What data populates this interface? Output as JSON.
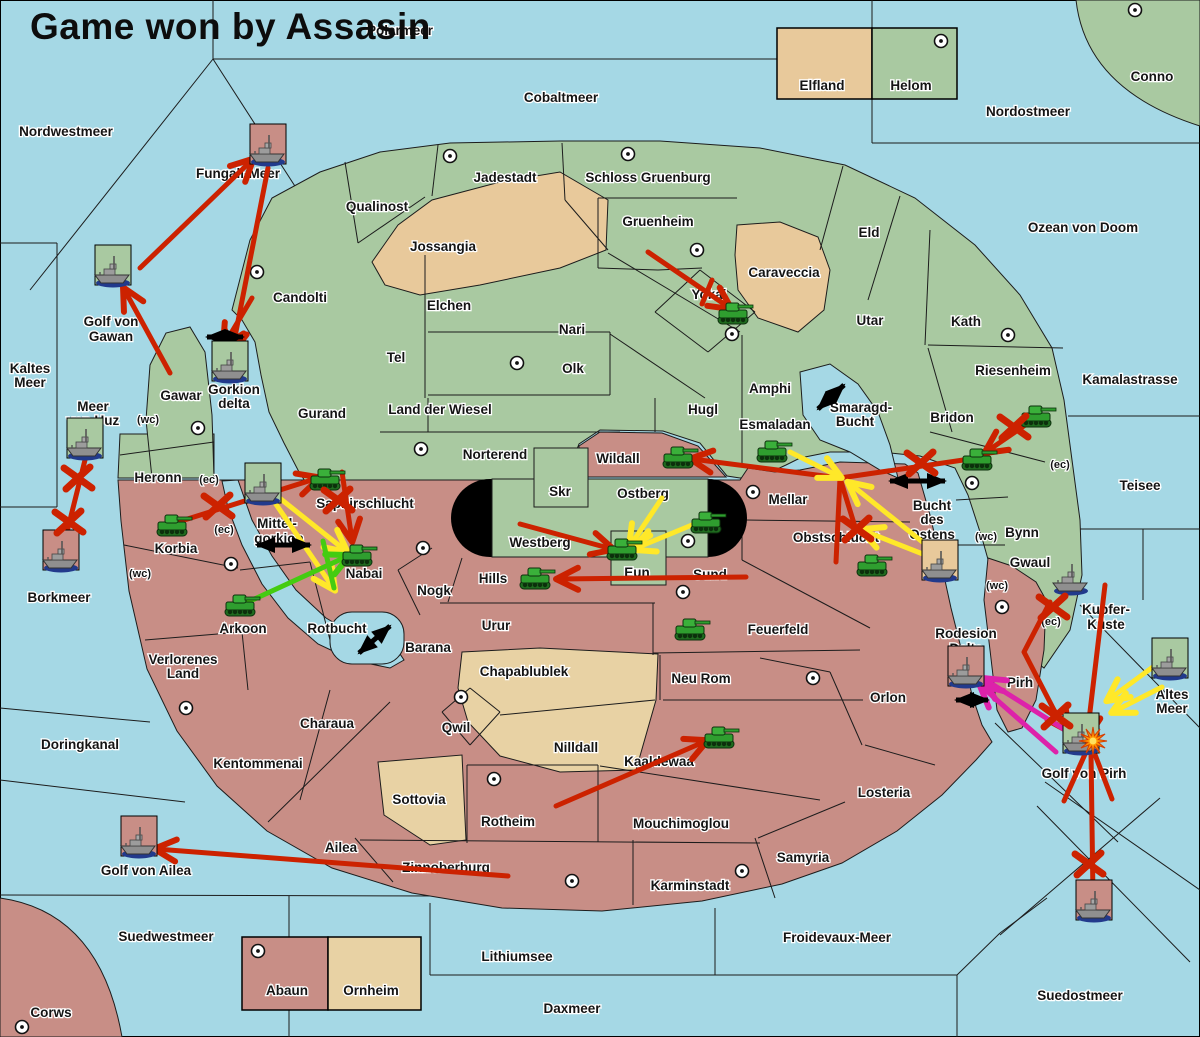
{
  "title": "Game won by Assasin",
  "colors": {
    "sea": "#a5d8e5",
    "land_green": "#a9c9a1",
    "land_tan": "#e8c99b",
    "land_pale": "#e8d2a4",
    "land_red": "#c88e86",
    "border": "#1c1c1c",
    "arrow_red": "#cc2200",
    "arrow_yellow": "#ffe829",
    "arrow_green": "#44cc11",
    "arrow_magenta": "#dd22aa",
    "arrow_black": "#000000",
    "tank": "#2f9e2f",
    "ship": "#8f8f8f",
    "ship_shadow": "#223a8c",
    "capsule": "#000000"
  },
  "legend_top": {
    "x": 777,
    "y": 28,
    "w": 180,
    "h": 71,
    "divider": 872,
    "items": [
      {
        "label": "Elfland",
        "color_key": "land_tan",
        "lx": 822,
        "ly": 90
      },
      {
        "label": "Helom",
        "color_key": "land_green",
        "lx": 911,
        "ly": 90
      }
    ]
  },
  "legend_bottom": {
    "x": 242,
    "y": 937,
    "w": 179,
    "h": 73,
    "divider": 328,
    "items": [
      {
        "label": "Abaun",
        "color_key": "land_red",
        "lx": 287,
        "ly": 995
      },
      {
        "label": "Ornheim",
        "color_key": "land_pale",
        "lx": 371,
        "ly": 995
      }
    ]
  },
  "labels": [
    {
      "t": "Polarmeer",
      "x": 400,
      "y": 35
    },
    {
      "t": "Nordwestmeer",
      "x": 66,
      "y": 136
    },
    {
      "t": "Cobaltmeer",
      "x": 561,
      "y": 102
    },
    {
      "t": "Nordostmeer",
      "x": 1028,
      "y": 116
    },
    {
      "t": "Conno",
      "x": 1152,
      "y": 81
    },
    {
      "t": "Ozean von Doom",
      "x": 1083,
      "y": 232
    },
    {
      "t": "Fungali-Meer",
      "x": 238,
      "y": 178
    },
    {
      "t": "Jadestadt",
      "x": 505,
      "y": 182
    },
    {
      "t": "Schloss Gruenburg",
      "x": 648,
      "y": 182
    },
    {
      "t": "Qualinost",
      "x": 377,
      "y": 211
    },
    {
      "t": "Jossangia",
      "x": 443,
      "y": 251
    },
    {
      "t": "Gruenheim",
      "x": 658,
      "y": 226
    },
    {
      "t": "Caraveccia",
      "x": 784,
      "y": 277
    },
    {
      "t": "Eld",
      "x": 869,
      "y": 237
    },
    {
      "t": "Yokai",
      "x": 709,
      "y": 299
    },
    {
      "t": "Utar",
      "x": 870,
      "y": 325
    },
    {
      "t": "Kath",
      "x": 966,
      "y": 326
    },
    {
      "t": "Riesenheim",
      "x": 1013,
      "y": 375
    },
    {
      "t": "Kamalastrasse",
      "x": 1130,
      "y": 384
    },
    {
      "t": "Candolti",
      "x": 300,
      "y": 302
    },
    {
      "t": "Elchen",
      "x": 449,
      "y": 310
    },
    {
      "t": "Nari",
      "x": 572,
      "y": 334
    },
    {
      "t": "Tel",
      "x": 396,
      "y": 362
    },
    {
      "t": "Olk",
      "x": 573,
      "y": 373
    },
    {
      "t": "Golf von",
      "x": 111,
      "y": 326
    },
    {
      "t": "Gawan",
      "x": 111,
      "y": 341
    },
    {
      "t": "Kaltes",
      "x": 30,
      "y": 373
    },
    {
      "t": "Meer",
      "x": 30,
      "y": 387
    },
    {
      "t": "Meer",
      "x": 93,
      "y": 411
    },
    {
      "t": "von Uuz",
      "x": 93,
      "y": 425
    },
    {
      "t": "Gawar",
      "x": 181,
      "y": 400
    },
    {
      "t": "Gorkion",
      "x": 234,
      "y": 394
    },
    {
      "t": "delta",
      "x": 234,
      "y": 408
    },
    {
      "t": "Gurand",
      "x": 322,
      "y": 418
    },
    {
      "t": "Land der Wiesel",
      "x": 440,
      "y": 414
    },
    {
      "t": "Hugl",
      "x": 703,
      "y": 414
    },
    {
      "t": "Amphi",
      "x": 770,
      "y": 393
    },
    {
      "t": "Esmaladan",
      "x": 775,
      "y": 429
    },
    {
      "t": "Smaragd-",
      "x": 861,
      "y": 412
    },
    {
      "t": "Bucht",
      "x": 855,
      "y": 426
    },
    {
      "t": "Bridon",
      "x": 952,
      "y": 422
    },
    {
      "t": "Teisee",
      "x": 1140,
      "y": 490
    },
    {
      "t": "Norterend",
      "x": 495,
      "y": 459
    },
    {
      "t": "Wildall",
      "x": 618,
      "y": 463
    },
    {
      "t": "Heronn",
      "x": 158,
      "y": 482
    },
    {
      "t": "Skr",
      "x": 560,
      "y": 496
    },
    {
      "t": "Ostberg",
      "x": 643,
      "y": 498
    },
    {
      "t": "Mellar",
      "x": 788,
      "y": 504
    },
    {
      "t": "Bucht",
      "x": 932,
      "y": 510
    },
    {
      "t": "des",
      "x": 932,
      "y": 524
    },
    {
      "t": "Ostens",
      "x": 932,
      "y": 539
    },
    {
      "t": "Bynn",
      "x": 1022,
      "y": 537
    },
    {
      "t": "Saphirschlucht",
      "x": 365,
      "y": 508
    },
    {
      "t": "Mittel-",
      "x": 277,
      "y": 528
    },
    {
      "t": "gorkion",
      "x": 279,
      "y": 543
    },
    {
      "t": "Korbia",
      "x": 176,
      "y": 553
    },
    {
      "t": "Westberg",
      "x": 540,
      "y": 547
    },
    {
      "t": "Gwaul",
      "x": 1030,
      "y": 567
    },
    {
      "t": "Hills",
      "x": 493,
      "y": 583
    },
    {
      "t": "Eun",
      "x": 637,
      "y": 577
    },
    {
      "t": "Sund",
      "x": 710,
      "y": 579
    },
    {
      "t": "Obstschlucht",
      "x": 836,
      "y": 542
    },
    {
      "t": "Nabai",
      "x": 364,
      "y": 578
    },
    {
      "t": "Borkmeer",
      "x": 59,
      "y": 602
    },
    {
      "t": "Kupfer-",
      "x": 1106,
      "y": 614
    },
    {
      "t": "Küste",
      "x": 1106,
      "y": 629
    },
    {
      "t": "Nogk",
      "x": 434,
      "y": 595
    },
    {
      "t": "Arkoon",
      "x": 243,
      "y": 633
    },
    {
      "t": "Rotbucht",
      "x": 337,
      "y": 633
    },
    {
      "t": "Barana",
      "x": 428,
      "y": 652
    },
    {
      "t": "Urur",
      "x": 496,
      "y": 630
    },
    {
      "t": "Rodesion",
      "x": 966,
      "y": 638
    },
    {
      "t": "Delta",
      "x": 966,
      "y": 653
    },
    {
      "t": "Verlorenes",
      "x": 183,
      "y": 664
    },
    {
      "t": "Land",
      "x": 183,
      "y": 678
    },
    {
      "t": "Chapablublek",
      "x": 524,
      "y": 676
    },
    {
      "t": "Neu Rom",
      "x": 701,
      "y": 683
    },
    {
      "t": "Feuerfeld",
      "x": 778,
      "y": 634
    },
    {
      "t": "Orlon",
      "x": 888,
      "y": 702
    },
    {
      "t": "Pirh",
      "x": 1020,
      "y": 687
    },
    {
      "t": "Altes",
      "x": 1172,
      "y": 699
    },
    {
      "t": "Meer",
      "x": 1172,
      "y": 713
    },
    {
      "t": "Golf von Pirh",
      "x": 1084,
      "y": 778
    },
    {
      "t": "Doringkanal",
      "x": 80,
      "y": 749
    },
    {
      "t": "Charaua",
      "x": 327,
      "y": 728
    },
    {
      "t": "Qwil",
      "x": 456,
      "y": 732
    },
    {
      "t": "Kentommenai",
      "x": 258,
      "y": 768
    },
    {
      "t": "Nilldall",
      "x": 576,
      "y": 752
    },
    {
      "t": "Kaaldewaa",
      "x": 659,
      "y": 766
    },
    {
      "t": "Sottovia",
      "x": 419,
      "y": 804
    },
    {
      "t": "Rotheim",
      "x": 508,
      "y": 826
    },
    {
      "t": "Mouchimoglou",
      "x": 681,
      "y": 828
    },
    {
      "t": "Losteria",
      "x": 884,
      "y": 797
    },
    {
      "t": "Ailea",
      "x": 341,
      "y": 852
    },
    {
      "t": "Zinnoberburg",
      "x": 446,
      "y": 872
    },
    {
      "t": "Samyria",
      "x": 803,
      "y": 862
    },
    {
      "t": "Karminstadt",
      "x": 690,
      "y": 890
    },
    {
      "t": "Golf von Ailea",
      "x": 146,
      "y": 875
    },
    {
      "t": "Froidevaux-Meer",
      "x": 837,
      "y": 942
    },
    {
      "t": "Suedwestmeer",
      "x": 166,
      "y": 941
    },
    {
      "t": "Lithiumsee",
      "x": 517,
      "y": 961
    },
    {
      "t": "Daxmeer",
      "x": 572,
      "y": 1013
    },
    {
      "t": "Suedostmeer",
      "x": 1080,
      "y": 1000
    },
    {
      "t": "Corws",
      "x": 51,
      "y": 1017
    }
  ],
  "coast_tags": [
    {
      "t": "(wc)",
      "x": 148,
      "y": 423
    },
    {
      "t": "(ec)",
      "x": 209,
      "y": 483
    },
    {
      "t": "(ec)",
      "x": 224,
      "y": 533
    },
    {
      "t": "(wc)",
      "x": 140,
      "y": 577
    },
    {
      "t": "(ec)",
      "x": 1060,
      "y": 468
    },
    {
      "t": "(wc)",
      "x": 986,
      "y": 540
    },
    {
      "t": "(wc)",
      "x": 997,
      "y": 589
    },
    {
      "t": "(ec)",
      "x": 1051,
      "y": 625
    }
  ],
  "supply_centers": [
    [
      450,
      156
    ],
    [
      628,
      154
    ],
    [
      941,
      41
    ],
    [
      1135,
      10
    ],
    [
      257,
      272
    ],
    [
      517,
      363
    ],
    [
      697,
      250
    ],
    [
      732,
      334
    ],
    [
      1008,
      335
    ],
    [
      198,
      428
    ],
    [
      421,
      449
    ],
    [
      688,
      541
    ],
    [
      683,
      592
    ],
    [
      753,
      492
    ],
    [
      972,
      483
    ],
    [
      231,
      564
    ],
    [
      423,
      548
    ],
    [
      186,
      708
    ],
    [
      461,
      697
    ],
    [
      494,
      779
    ],
    [
      572,
      881
    ],
    [
      742,
      871
    ],
    [
      813,
      678
    ],
    [
      1002,
      607
    ],
    [
      22,
      1027
    ],
    [
      258,
      951
    ]
  ],
  "tanks": [
    [
      733,
      313
    ],
    [
      678,
      457
    ],
    [
      706,
      522
    ],
    [
      622,
      549
    ],
    [
      535,
      578
    ],
    [
      172,
      525
    ],
    [
      325,
      479
    ],
    [
      357,
      555
    ],
    [
      240,
      605
    ],
    [
      772,
      451
    ],
    [
      872,
      565
    ],
    [
      690,
      629
    ],
    [
      719,
      737
    ],
    [
      977,
      459
    ],
    [
      1036,
      416
    ]
  ],
  "fleets": [
    {
      "x": 268,
      "y": 150,
      "sq": "land_red"
    },
    {
      "x": 113,
      "y": 271,
      "sq": "land_green"
    },
    {
      "x": 230,
      "y": 367,
      "sq": "land_green"
    },
    {
      "x": 85,
      "y": 444,
      "sq": "land_green"
    },
    {
      "x": 61,
      "y": 556,
      "sq": "land_red"
    },
    {
      "x": 263,
      "y": 489,
      "sq": "land_green"
    },
    {
      "x": 940,
      "y": 566,
      "sq": "land_tan"
    },
    {
      "x": 1071,
      "y": 579,
      "sq": null
    },
    {
      "x": 966,
      "y": 672,
      "sq": "land_red"
    },
    {
      "x": 1081,
      "y": 739,
      "sq": "land_green",
      "explode": true
    },
    {
      "x": 1170,
      "y": 664,
      "sq": "land_green"
    },
    {
      "x": 1094,
      "y": 906,
      "sq": "land_red"
    },
    {
      "x": 139,
      "y": 842,
      "sq": "land_red"
    }
  ],
  "arrows": [
    {
      "c": "red",
      "h": 1,
      "p": [
        [
          140,
          268
        ],
        [
          252,
          160
        ]
      ]
    },
    {
      "c": "red",
      "h": 1,
      "p": [
        [
          170,
          373
        ],
        [
          124,
          289
        ]
      ]
    },
    {
      "c": "red",
      "h": 1,
      "p": [
        [
          268,
          168
        ],
        [
          232,
          352
        ]
      ]
    },
    {
      "c": "red",
      "h": 1,
      "p": [
        [
          252,
          298
        ],
        [
          224,
          345
        ]
      ]
    },
    {
      "c": "red",
      "h": 0,
      "p": [
        [
          85,
          460
        ],
        [
          63,
          548
        ]
      ]
    },
    {
      "c": "red",
      "h": 1,
      "p": [
        [
          178,
          522
        ],
        [
          318,
          478
        ]
      ]
    },
    {
      "c": "red",
      "h": 1,
      "p": [
        [
          342,
          472
        ],
        [
          352,
          540
        ]
      ]
    },
    {
      "c": "red",
      "h": 1,
      "p": [
        [
          746,
          577
        ],
        [
          558,
          579
        ]
      ]
    },
    {
      "c": "red",
      "h": 1,
      "p": [
        [
          520,
          524
        ],
        [
          612,
          549
        ]
      ]
    },
    {
      "c": "red",
      "h": 1,
      "p": [
        [
          977,
          458
        ],
        [
          840,
          478
        ],
        [
          692,
          459
        ]
      ]
    },
    {
      "c": "red",
      "h": 0,
      "p": [
        [
          840,
          478
        ],
        [
          856,
          530
        ]
      ]
    },
    {
      "c": "red",
      "h": 0,
      "p": [
        [
          840,
          478
        ],
        [
          836,
          562
        ]
      ]
    },
    {
      "c": "red",
      "h": 1,
      "p": [
        [
          1034,
          419
        ],
        [
          986,
          452
        ]
      ]
    },
    {
      "c": "red",
      "h": 1,
      "p": [
        [
          1105,
          585
        ],
        [
          1087,
          737
        ]
      ]
    },
    {
      "c": "red",
      "h": 1,
      "p": [
        [
          1050,
          602
        ],
        [
          1024,
          652
        ],
        [
          1054,
          710
        ],
        [
          1068,
          730
        ]
      ]
    },
    {
      "c": "red",
      "h": 0,
      "p": [
        [
          1086,
          752
        ],
        [
          1064,
          801
        ]
      ]
    },
    {
      "c": "red",
      "h": 0,
      "p": [
        [
          1094,
          752
        ],
        [
          1112,
          799
        ]
      ]
    },
    {
      "c": "red",
      "h": 0,
      "p": [
        [
          1091,
          752
        ],
        [
          1093,
          897
        ]
      ]
    },
    {
      "c": "red",
      "h": 1,
      "p": [
        [
          556,
          806
        ],
        [
          706,
          741
        ]
      ]
    },
    {
      "c": "red",
      "h": 1,
      "p": [
        [
          508,
          876
        ],
        [
          156,
          849
        ]
      ]
    },
    {
      "c": "red",
      "h": 1,
      "p": [
        [
          648,
          252
        ],
        [
          730,
          308
        ]
      ]
    },
    {
      "c": "red",
      "h": 0,
      "p": [
        [
          712,
          280
        ],
        [
          702,
          304
        ]
      ]
    },
    {
      "c": "yellow",
      "h": 1,
      "p": [
        [
          790,
          452
        ],
        [
          840,
          477
        ]
      ]
    },
    {
      "c": "yellow",
      "h": 1,
      "p": [
        [
          938,
          560
        ],
        [
          862,
          530
        ]
      ]
    },
    {
      "c": "yellow",
      "h": 1,
      "p": [
        [
          930,
          548
        ],
        [
          849,
          483
        ]
      ]
    },
    {
      "c": "yellow",
      "h": 1,
      "p": [
        [
          662,
          498
        ],
        [
          630,
          546
        ]
      ]
    },
    {
      "c": "yellow",
      "h": 1,
      "p": [
        [
          704,
          520
        ],
        [
          634,
          549
        ]
      ]
    },
    {
      "c": "yellow",
      "h": 1,
      "p": [
        [
          272,
          492
        ],
        [
          346,
          551
        ]
      ]
    },
    {
      "c": "yellow",
      "h": 1,
      "p": [
        [
          271,
          497
        ],
        [
          334,
          589
        ]
      ]
    },
    {
      "c": "yellow",
      "h": 1,
      "p": [
        [
          1157,
          664
        ],
        [
          1108,
          700
        ]
      ]
    },
    {
      "c": "yellow",
      "h": 1,
      "p": [
        [
          1162,
          687
        ],
        [
          1113,
          712
        ]
      ]
    },
    {
      "c": "green",
      "h": 1,
      "p": [
        [
          248,
          602
        ],
        [
          348,
          556
        ]
      ]
    },
    {
      "c": "green",
      "h": 0,
      "p": [
        [
          323,
          541
        ],
        [
          334,
          588
        ]
      ]
    },
    {
      "c": "magenta",
      "h": 1,
      "p": [
        [
          1070,
          733
        ],
        [
          984,
          679
        ]
      ]
    },
    {
      "c": "magenta",
      "h": 1,
      "p": [
        [
          1056,
          752
        ],
        [
          981,
          686
        ]
      ]
    }
  ],
  "x_marks": [
    [
      78,
      478
    ],
    [
      69,
      522
    ],
    [
      218,
      506
    ],
    [
      338,
      500
    ],
    [
      857,
      529
    ],
    [
      921,
      463
    ],
    [
      1014,
      427
    ],
    [
      1053,
      607
    ],
    [
      1056,
      716
    ],
    [
      1089,
      864
    ]
  ],
  "double_arrows": [
    [
      207,
      337,
      243,
      337
    ],
    [
      257,
      545,
      310,
      545
    ],
    [
      359,
      653,
      390,
      626
    ],
    [
      818,
      409,
      844,
      385
    ],
    [
      890,
      481,
      945,
      481
    ],
    [
      956,
      700,
      988,
      700
    ]
  ],
  "explosion": {
    "x": 1093,
    "y": 741
  }
}
